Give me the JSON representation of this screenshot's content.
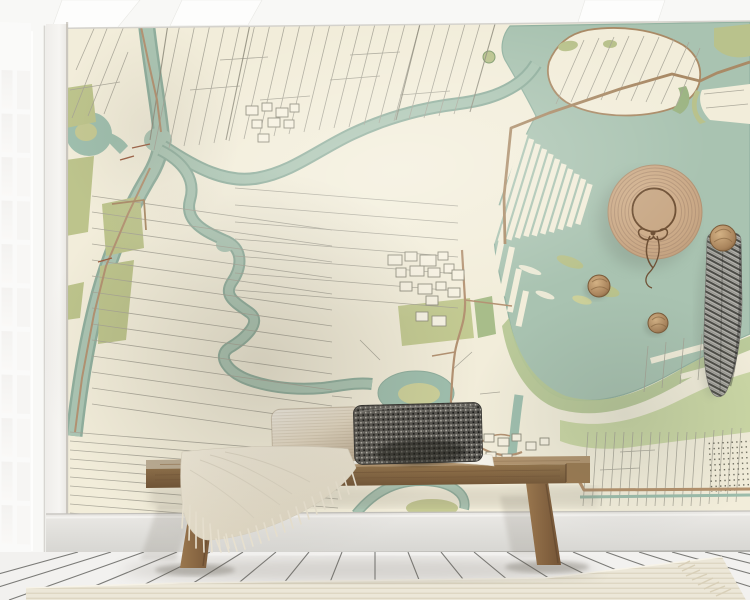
{
  "scene": {
    "kind": "interior mockup photo of a map wall mural",
    "wall_mural": {
      "style": "vintage cadastral polder map",
      "land_color": "#f2edda",
      "water_color": "#a9c3b1",
      "water_edge_color": "#8fae9d",
      "field_olive_color": "#bdc48c",
      "field_green_color": "#cbd7a5",
      "road_color": "#a98a66",
      "parcel_line_color": "#a6a396",
      "features": [
        "large lake",
        "polder strip parcels",
        "meandering river",
        "canal",
        "ring pond with island",
        "village building blocks",
        "orchard rows"
      ]
    },
    "architecture": {
      "ceiling_color": "#f8f8f6",
      "window": {
        "pane_columns": 2,
        "pane_rows": 11,
        "frame_color": "#fafaf9",
        "glass_color": "#f3f2f0"
      },
      "baseboard_color": "#e4e3df",
      "floor_color": "#f2f1ef",
      "floor_type": "white painted planks"
    },
    "furniture": {
      "bench": {
        "material": "wood",
        "seat_color": "#8f7049",
        "leg_count": 2,
        "leg_color": "#8a6a45"
      }
    },
    "textiles": {
      "pillows": [
        {
          "style": "woven gradient lumbar",
          "color": "#e8decb"
        },
        {
          "style": "speckled tweed lumbar",
          "color": "#4a4846"
        }
      ],
      "throw_blanket": {
        "color": "#ece5d4",
        "fringed": true
      },
      "rug": {
        "color": "#ece7d8",
        "weave": "ribbed",
        "fringed": true
      }
    },
    "decor": {
      "straw_hat": {
        "color": "#c9a987",
        "band_color": "#6f5136",
        "bow": true
      },
      "wall_knobs": {
        "count": 3,
        "color": "#a9845c"
      },
      "hanging_scarf": {
        "pattern": "herringbone knit",
        "color": "#8f8d88"
      }
    }
  }
}
